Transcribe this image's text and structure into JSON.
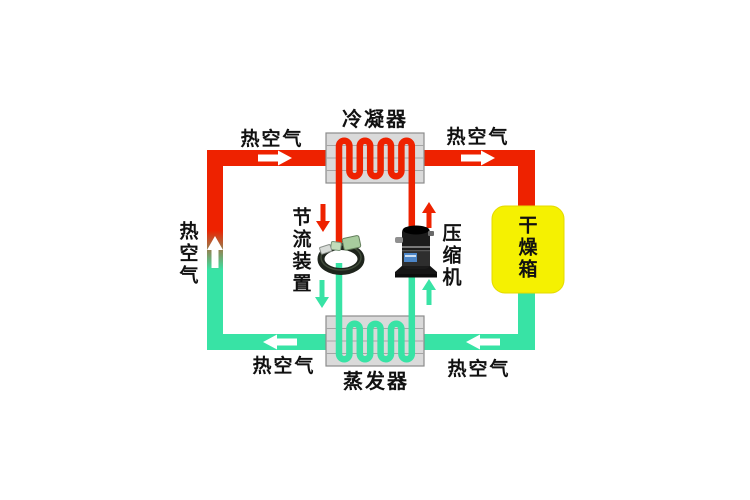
{
  "diagram": {
    "labels": {
      "condenser": "冷凝器",
      "evaporator": "蒸发器",
      "throttle_device": "节流装置",
      "compressor": "压缩机",
      "drying_box": "干燥箱",
      "hot_air": "热空气"
    },
    "colors": {
      "hot_pipe": "#ee2200",
      "cold_pipe": "#38e3a5",
      "dryer_box": "#f5f101",
      "dryer_edge": "#e4d900",
      "exchanger_box": "#dadada",
      "exchanger_border": "#8c8c8c",
      "exchanger_line": "#a5a5a5",
      "arrow_white": "#ffffff",
      "label_text": "#111111"
    }
  }
}
